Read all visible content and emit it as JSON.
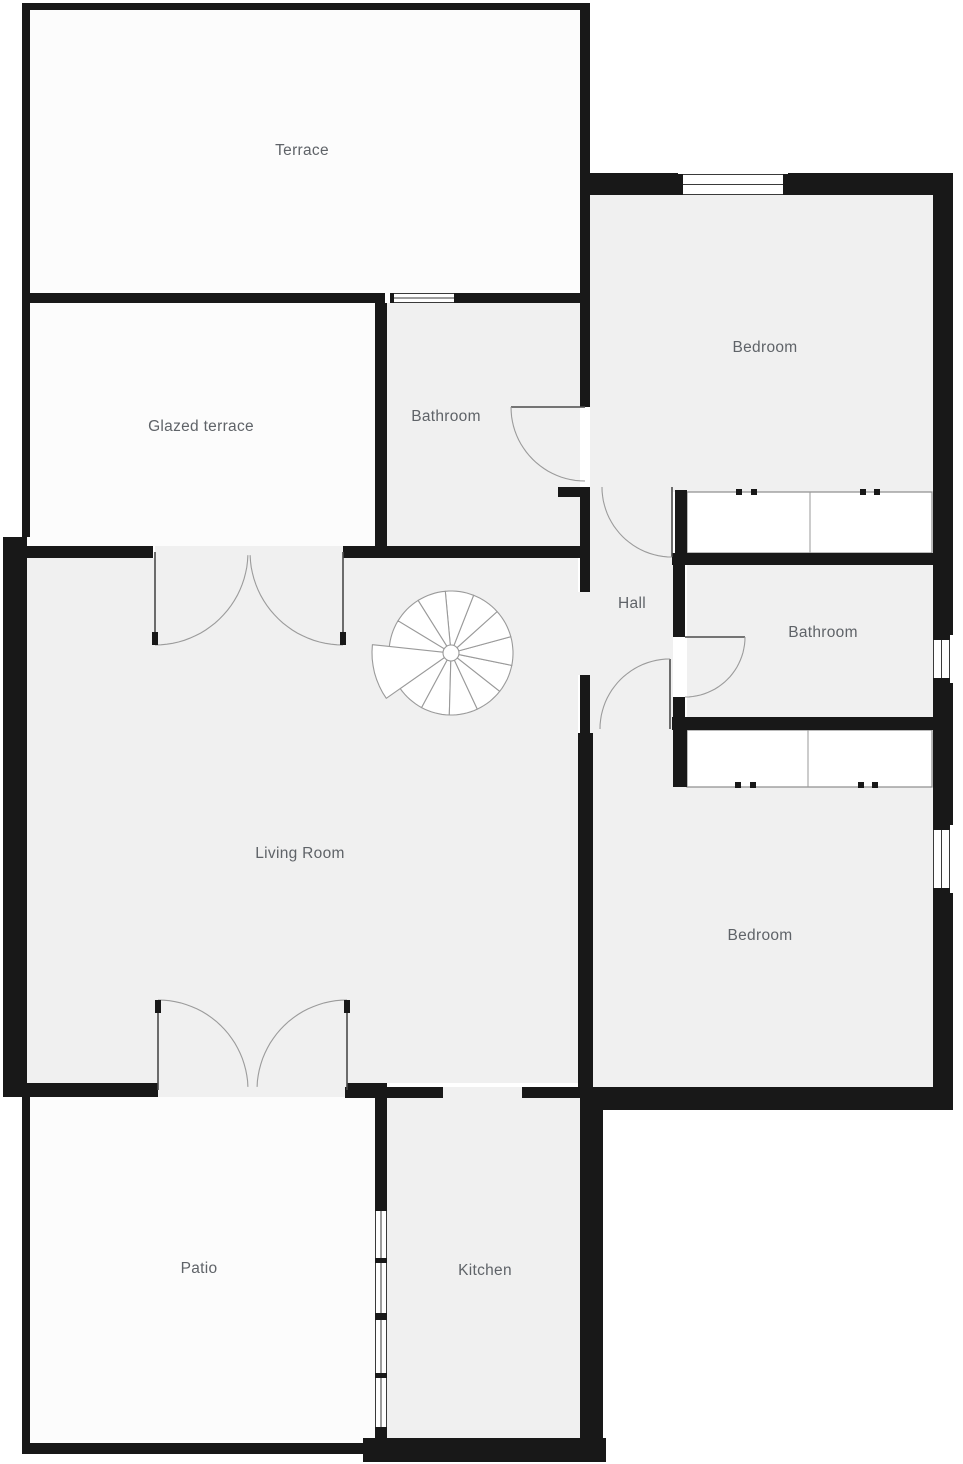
{
  "page": {
    "title": "Apartment floor plan"
  },
  "canvas": {
    "width": 963,
    "height": 1464
  },
  "palette": {
    "background": "#ffffff",
    "wall": "#181818",
    "room_fill": "#f0f0f0",
    "outdoor_fill": "#fcfcfc",
    "label_color": "#5f6368",
    "label_size": 15.5,
    "door_arc": "#9b9b9b",
    "door_leaf": "#4a4a4a",
    "window_line": "#3a3a3a",
    "closet_line": "#8c8c8c",
    "closet_divider": "#9a9a9a",
    "stair_line": "#9a9a9a",
    "stair_fill": "#ffffff"
  },
  "rooms": [
    {
      "id": "terrace",
      "label": "Terrace",
      "type": "outdoor",
      "rect": [
        30,
        10,
        550,
        283
      ],
      "label_pos": [
        302,
        155
      ]
    },
    {
      "id": "glazed-terrace",
      "label": "Glazed terrace",
      "type": "outdoor",
      "rect": [
        30,
        303,
        345,
        243
      ],
      "label_pos": [
        201,
        431
      ]
    },
    {
      "id": "bathroom-top",
      "label": "Bathroom",
      "type": "indoor",
      "rect": [
        387,
        303,
        193,
        243
      ],
      "label_pos": [
        446,
        421
      ]
    },
    {
      "id": "bedroom-top",
      "label": "Bedroom",
      "type": "indoor",
      "rect": [
        590,
        195,
        343,
        297
      ],
      "label_pos": [
        765,
        352
      ]
    },
    {
      "id": "hall",
      "label": "Hall",
      "type": "indoor",
      "rect": [
        590,
        487,
        83,
        246
      ],
      "label_pos": [
        632,
        608
      ]
    },
    {
      "id": "bathroom-right",
      "label": "Bathroom",
      "type": "indoor",
      "rect": [
        687,
        565,
        246,
        152
      ],
      "label_pos": [
        823,
        637
      ]
    },
    {
      "id": "living-room",
      "label": "Living Room",
      "type": "indoor",
      "rect": [
        27,
        558,
        551,
        525
      ],
      "label_pos": [
        300,
        858
      ]
    },
    {
      "id": "bedroom-bottom",
      "label": "Bedroom",
      "type": "indoor",
      "rect": [
        590,
        733,
        343,
        354
      ],
      "label_pos": [
        760,
        940
      ]
    },
    {
      "id": "patio",
      "label": "Patio",
      "type": "outdoor",
      "rect": [
        30,
        1096,
        345,
        347
      ],
      "label_pos": [
        199,
        1273
      ]
    },
    {
      "id": "kitchen",
      "label": "Kitchen",
      "type": "indoor",
      "rect": [
        387,
        1098,
        193,
        342
      ],
      "label_pos": [
        485,
        1275
      ]
    }
  ],
  "floor_patches": [
    {
      "id": "hall-living-opening",
      "rect": [
        578,
        592,
        15,
        83
      ]
    },
    {
      "id": "kitchen-opening",
      "rect": [
        443,
        1087,
        79,
        11
      ]
    },
    {
      "id": "terrace-door-opening",
      "rect": [
        155,
        546,
        188,
        12
      ]
    },
    {
      "id": "patio-door-opening",
      "rect": [
        158,
        1083,
        189,
        14
      ]
    }
  ],
  "walls": [
    [
      22,
      3,
      568,
      7
    ],
    [
      22,
      3,
      8,
      534
    ],
    [
      3,
      537,
      24,
      560
    ],
    [
      22,
      1085,
      8,
      368
    ],
    [
      22,
      1443,
      356,
      11
    ],
    [
      363,
      1438,
      243,
      24
    ],
    [
      580,
      3,
      10,
      300
    ],
    [
      583,
      173,
      95,
      22
    ],
    [
      788,
      173,
      165,
      22
    ],
    [
      933,
      173,
      20,
      462
    ],
    [
      933,
      683,
      20,
      142
    ],
    [
      933,
      893,
      20,
      217
    ],
    [
      585,
      1087,
      368,
      23
    ],
    [
      580,
      1090,
      23,
      370
    ],
    [
      22,
      293,
      363,
      10
    ],
    [
      458,
      293,
      122,
      10
    ],
    [
      375,
      303,
      12,
      243
    ],
    [
      580,
      303,
      10,
      104
    ],
    [
      27,
      546,
      126,
      12
    ],
    [
      343,
      546,
      247,
      12
    ],
    [
      558,
      487,
      32,
      10
    ],
    [
      580,
      487,
      10,
      105
    ],
    [
      580,
      675,
      10,
      58
    ],
    [
      578,
      733,
      15,
      357
    ],
    [
      675,
      490,
      12,
      63
    ],
    [
      672,
      553,
      263,
      12
    ],
    [
      673,
      565,
      12,
      72
    ],
    [
      673,
      697,
      12,
      20
    ],
    [
      672,
      717,
      261,
      13
    ],
    [
      673,
      730,
      14,
      57
    ],
    [
      27,
      1083,
      131,
      14
    ],
    [
      347,
      1083,
      40,
      14
    ],
    [
      345,
      1087,
      98,
      11
    ],
    [
      522,
      1087,
      71,
      11
    ],
    [
      375,
      1087,
      12,
      118
    ],
    [
      375,
      1433,
      12,
      10
    ]
  ],
  "windows": [
    {
      "id": "bedroom-top-window",
      "rect": [
        678,
        174,
        110,
        21
      ],
      "orient": "h",
      "caps": [
        [
          678,
          174,
          5,
          21
        ],
        [
          783,
          174,
          5,
          21
        ]
      ]
    },
    {
      "id": "bathroom-top-window",
      "rect": [
        390,
        293,
        68,
        10
      ],
      "orient": "h",
      "caps": [
        [
          390,
          293,
          4,
          10
        ],
        [
          454,
          293,
          4,
          10
        ]
      ]
    },
    {
      "id": "bathroom-right-window",
      "rect": [
        933,
        635,
        17,
        48
      ],
      "orient": "v",
      "caps": [
        [
          933,
          635,
          17,
          5
        ],
        [
          933,
          678,
          17,
          5
        ]
      ]
    },
    {
      "id": "bedroom-bottom-window",
      "rect": [
        933,
        825,
        17,
        68
      ],
      "orient": "v",
      "caps": [
        [
          933,
          825,
          17,
          5
        ],
        [
          933,
          888,
          17,
          5
        ]
      ]
    },
    {
      "id": "kitchen-window",
      "rect": [
        375,
        1205,
        12,
        228
      ],
      "orient": "v",
      "caps": [
        [
          375,
          1205,
          12,
          6
        ],
        [
          375,
          1258,
          12,
          5
        ],
        [
          375,
          1313,
          12,
          7
        ],
        [
          375,
          1373,
          12,
          5
        ],
        [
          375,
          1427,
          12,
          6
        ]
      ]
    }
  ],
  "doors": [
    {
      "id": "terrace-door-left",
      "hinge": [
        155,
        552
      ],
      "radius": 93,
      "leaf_deg": 90,
      "open_deg": 2,
      "tick": [
        152,
        632,
        6,
        13
      ]
    },
    {
      "id": "terrace-door-right",
      "hinge": [
        343,
        552
      ],
      "radius": 93,
      "leaf_deg": 90,
      "open_deg": 178,
      "tick": [
        340,
        632,
        6,
        13
      ]
    },
    {
      "id": "patio-door-left",
      "hinge": [
        158,
        1090
      ],
      "radius": 90,
      "leaf_deg": 270,
      "open_deg": 358,
      "tick": [
        155,
        1000,
        6,
        13
      ]
    },
    {
      "id": "patio-door-right",
      "hinge": [
        347,
        1090
      ],
      "radius": 90,
      "leaf_deg": 270,
      "open_deg": 182,
      "tick": [
        344,
        1000,
        6,
        13
      ]
    },
    {
      "id": "bathroom-top-door",
      "hinge": [
        585,
        407
      ],
      "radius": 74,
      "leaf_deg": 180,
      "open_deg": 90,
      "tick": null
    },
    {
      "id": "bedroom-top-door",
      "hinge": [
        672,
        487
      ],
      "radius": 70,
      "leaf_deg": 90,
      "open_deg": 180,
      "tick": null
    },
    {
      "id": "bathroom-right-door",
      "hinge": [
        685,
        637
      ],
      "radius": 60,
      "leaf_deg": 0,
      "open_deg": 90,
      "tick": null
    },
    {
      "id": "bedroom-bottom-door",
      "hinge": [
        670,
        729
      ],
      "radius": 70,
      "leaf_deg": 270,
      "open_deg": 180,
      "tick": null
    }
  ],
  "closets": [
    {
      "id": "closet-top",
      "rect": [
        687,
        492,
        245,
        61
      ],
      "divider_x": 810,
      "ticks": [
        [
          736,
          489,
          6,
          6
        ],
        [
          751,
          489,
          6,
          6
        ],
        [
          860,
          489,
          6,
          6
        ],
        [
          874,
          489,
          6,
          6
        ]
      ]
    },
    {
      "id": "closet-bottom",
      "rect": [
        687,
        730,
        245,
        57
      ],
      "divider_x": 808,
      "ticks": [
        [
          735,
          782,
          6,
          6
        ],
        [
          750,
          782,
          6,
          6
        ],
        [
          858,
          782,
          6,
          6
        ],
        [
          872,
          782,
          6,
          6
        ]
      ]
    }
  ],
  "stairs": {
    "cx": 451,
    "cy": 653,
    "outer_r": 62,
    "hub_r": 8,
    "wedge_start_deg": 145,
    "wedge_step_deg": -26.7,
    "wedge_count": 12,
    "big_wedge": {
      "from_deg": 145,
      "to_deg": 186,
      "r": 79
    }
  }
}
